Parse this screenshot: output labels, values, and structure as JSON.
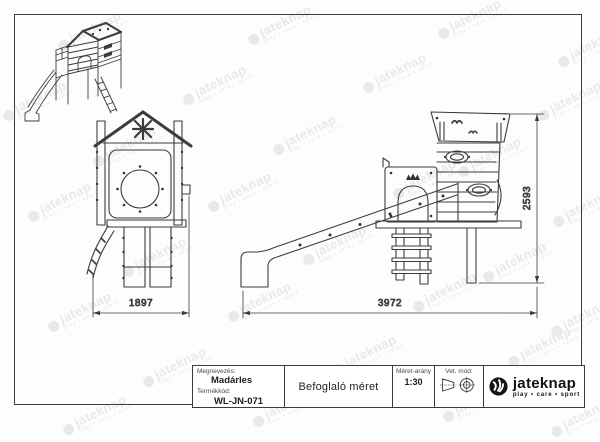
{
  "sheet": {
    "front_view": {
      "width_mm": "1897"
    },
    "side_view": {
      "length_mm": "3972",
      "height_mm": "2593"
    }
  },
  "title_block": {
    "name_label": "Megnevezés:",
    "name_value": "Madárles",
    "code_label": "Termékkód:",
    "code_value": "WL-JN-071",
    "drawing_title": "Befoglaló méret",
    "scale_label": "Méret-arány",
    "scale_value": "1:30",
    "projection_label": "Vet. mód:",
    "projection_icon": "first-angle-projection-symbol",
    "brand_name": "jateknap",
    "brand_tagline": "play • care • sport",
    "brand_icon": "swirl-ball-logo"
  },
  "watermark": {
    "text": "jateknap",
    "tagline": "play • care • sport"
  },
  "colors": {
    "line": "#3c3c3c",
    "watermark": "#e9e9e9",
    "brand": "#141414"
  }
}
